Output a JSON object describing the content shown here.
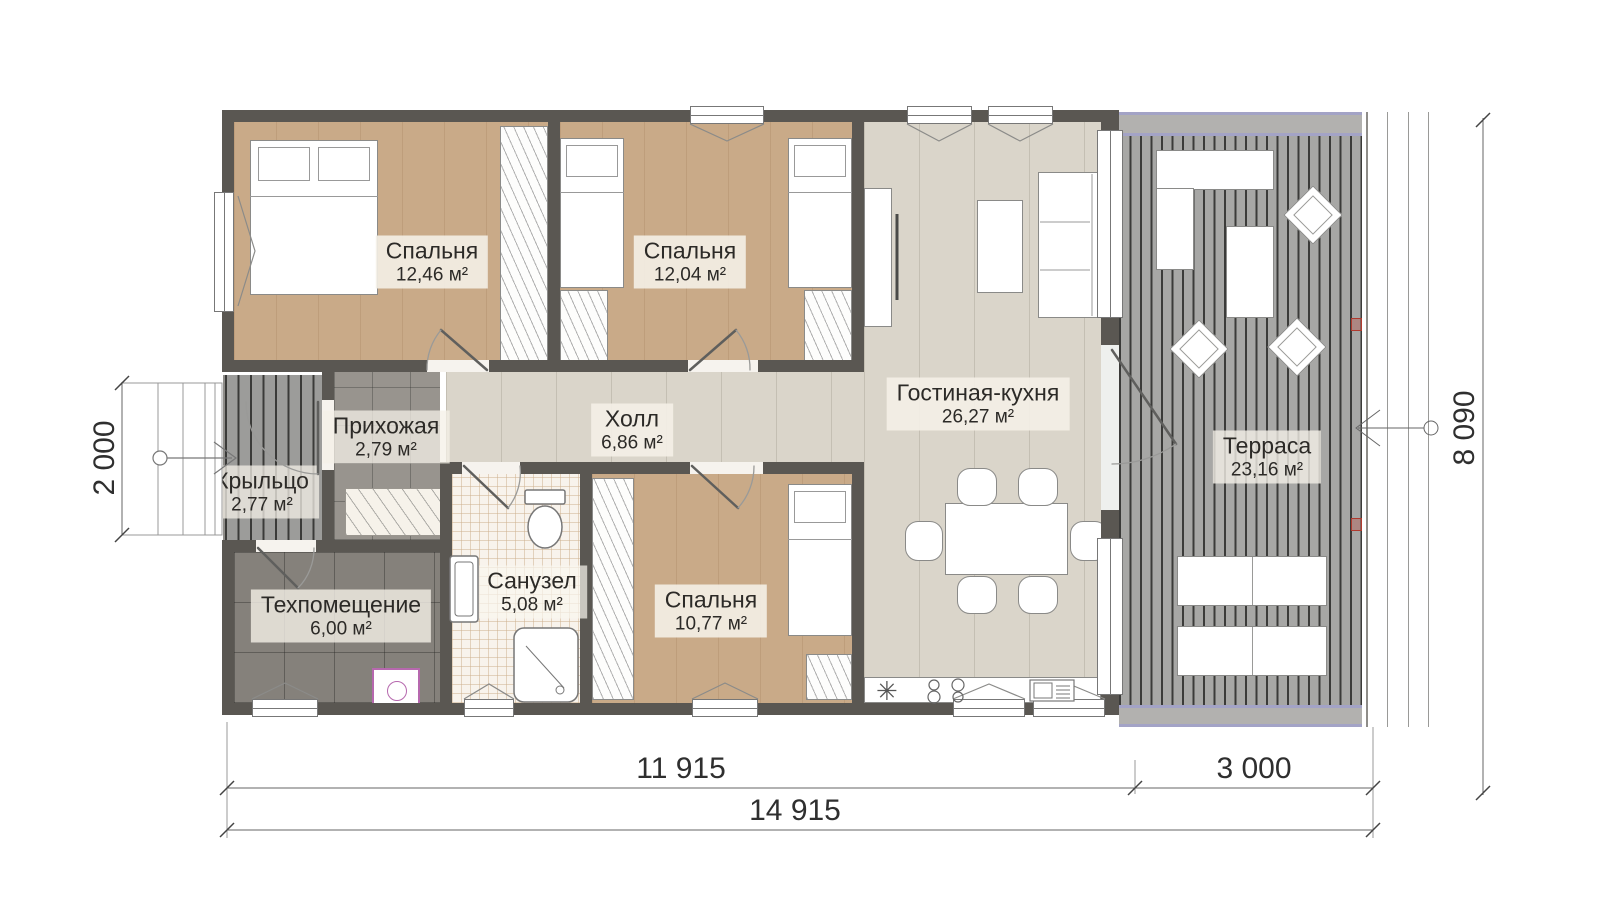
{
  "rooms": [
    {
      "id": "bedroom-1",
      "name": "Спальня",
      "area": "12,46 м²"
    },
    {
      "id": "bedroom-2",
      "name": "Спальня",
      "area": "12,04 м²"
    },
    {
      "id": "bedroom-3",
      "name": "Спальня",
      "area": "10,77 м²"
    },
    {
      "id": "living-kitchen",
      "name": "Гостиная-кухня",
      "area": "26,27 м²"
    },
    {
      "id": "hall",
      "name": "Холл",
      "area": "6,86 м²"
    },
    {
      "id": "entry",
      "name": "Прихожая",
      "area": "2,79 м²"
    },
    {
      "id": "porch",
      "name": "Крыльцо",
      "area": "2,77 м²"
    },
    {
      "id": "tech-room",
      "name": "Техпомещение",
      "area": "6,00 м²"
    },
    {
      "id": "bathroom",
      "name": "Санузел",
      "area": "5,08 м²"
    },
    {
      "id": "terrace",
      "name": "Терраса",
      "area": "23,16 м²"
    }
  ],
  "dimensions": {
    "left": "2 000",
    "right": "8 090",
    "bottom_house": "11 915",
    "bottom_terrace": "3 000",
    "bottom_total": "14 915"
  },
  "symbols": {
    "kitchen_sink": "✳"
  },
  "colors": {
    "wall": "#5a5752",
    "bedroom_floor": "#c9aa88",
    "living_floor": "#dad5ca",
    "entry_tile": "#98948e",
    "tech_tile": "#85817b",
    "bath_tile": "#f8f3ec",
    "deck": "#a7a7a5",
    "porch_deck": "#9c9c9a",
    "roof_band": "#b2b1af",
    "roof_band_line": "#a3a3c6",
    "accent_red": "#b03a2e"
  }
}
